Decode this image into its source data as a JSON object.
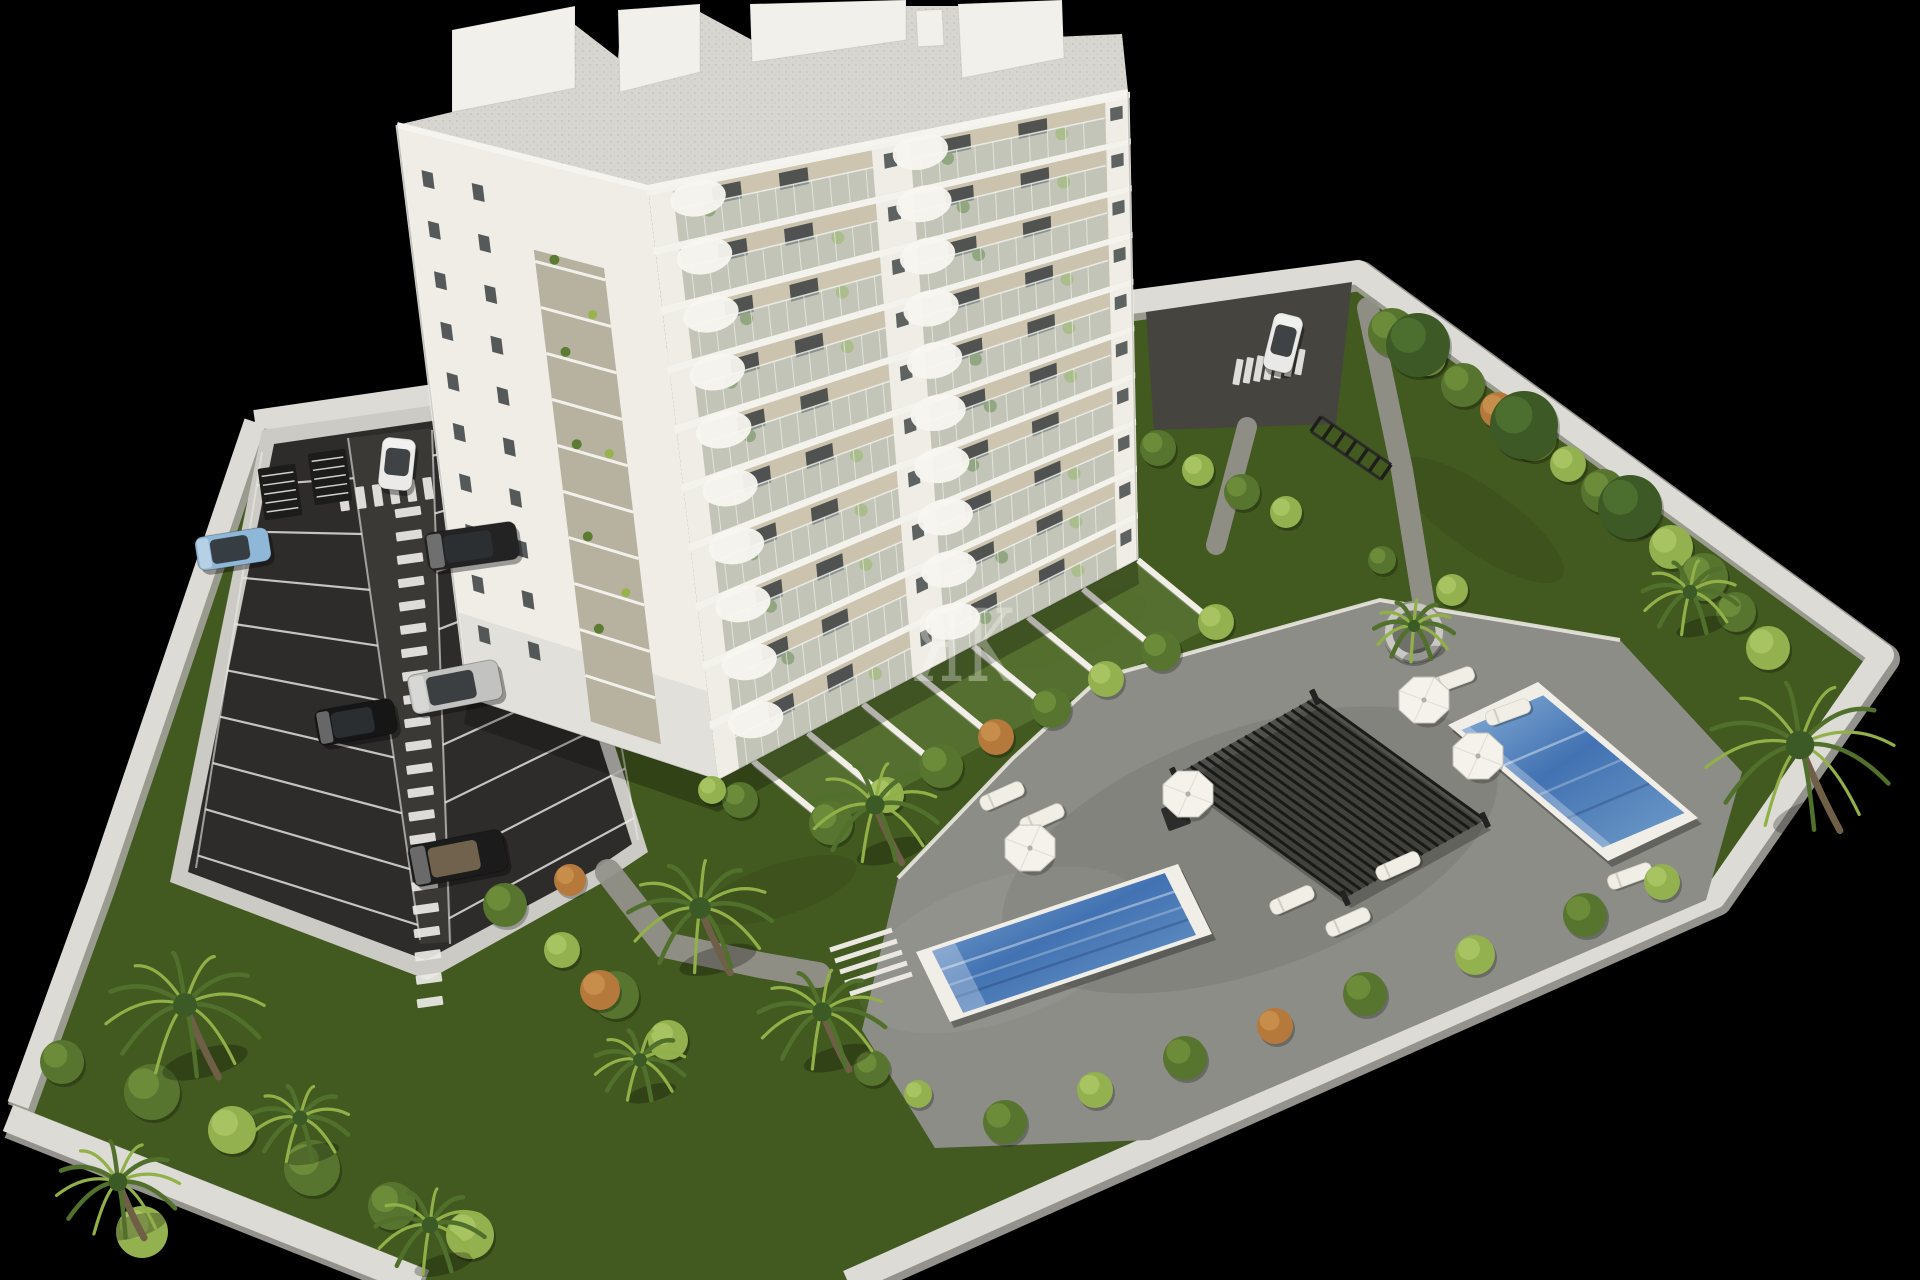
{
  "scene": {
    "description": "Aerial 3D architectural render: white multi-storey apartment building with balconies, landscaped garden, two blue swimming pools, sun deck with pergola and loungers, parking lot with cars, palm trees, white perimeter walls, on a black background",
    "background": "#000000",
    "watermark": {
      "text": "ЯK",
      "color": "#fbfaf6",
      "opacity": 0.33,
      "x": 912,
      "y": 681,
      "font_size": 100
    },
    "palette": {
      "wallLight": "#dcdbd5",
      "wallShade": "#a3a29b",
      "asphalt": "#2e2c2b",
      "asphaltLight": "#403e3c",
      "lineWhite": "#eceae6",
      "grass": "#42591f",
      "grassLight": "#567131",
      "apron": "#cbcac4",
      "deck": "#8d8d87",
      "pathGray": "#92918b",
      "poolBorder": "#f0eee7",
      "waterDeep": "#4272b2",
      "waterLight": "#86aed6",
      "buildingWhite": "#efede6",
      "facadeBeige": "#cdc5b0",
      "windowDark": "#3a3e3f",
      "plantGreen": "#5d7c33",
      "plantLight": "#97b34b",
      "palmDark": "#50702c",
      "palmLight": "#92b048",
      "roofSpeckle": "#d8d6d0"
    },
    "site": {
      "ground": [
        [
          255,
          422
        ],
        [
          1358,
          272
        ],
        [
          1882,
          655
        ],
        [
          1714,
          897
        ],
        [
          848,
          1282
        ],
        [
          408,
          1282
        ],
        [
          8,
          1118
        ],
        [
          98,
          885
        ]
      ],
      "walls": [
        {
          "pts": [
            [
              255,
              422
            ],
            [
              600,
              372
            ],
            [
              1358,
              272
            ],
            [
              1882,
              655
            ],
            [
              1714,
              897
            ],
            [
              848,
              1282
            ]
          ],
          "w": 24
        },
        {
          "pts": [
            [
              255,
              422
            ],
            [
              98,
              885
            ],
            [
              18,
              1105
            ]
          ],
          "w": 22
        },
        {
          "pts": [
            [
              8,
              1118
            ],
            [
              420,
              1282
            ]
          ],
          "w": 28
        }
      ]
    },
    "parking": {
      "apron": [
        [
          262,
          430
        ],
        [
          505,
          395
        ],
        [
          648,
          852
        ],
        [
          600,
          884
        ],
        [
          428,
          980
        ],
        [
          170,
          882
        ]
      ],
      "asphalt": [
        [
          274,
          444
        ],
        [
          494,
          412
        ],
        [
          632,
          844
        ],
        [
          594,
          870
        ],
        [
          426,
          960
        ],
        [
          188,
          872
        ]
      ],
      "lane": [
        [
          348,
          438
        ],
        [
          432,
          428
        ],
        [
          452,
          942
        ],
        [
          420,
          944
        ]
      ],
      "stall_fans": [
        {
          "a0": [
            262,
            452
          ],
          "a1": [
            196,
            868
          ],
          "b0": [
            348,
            438
          ],
          "b1": [
            420,
            940
          ],
          "n": 9,
          "t0": 0.08,
          "t1": 0.97
        },
        {
          "a0": [
            432,
            430
          ],
          "a1": [
            450,
            944
          ],
          "b0": [
            560,
            400
          ],
          "b1": [
            638,
            840
          ],
          "n": 9,
          "t0": 0.05,
          "t1": 0.95
        }
      ],
      "zebras": [
        {
          "from": [
            344,
            500
          ],
          "to": [
            546,
            472
          ],
          "count": 13,
          "bw": 9,
          "bl": 22,
          "rot": -8
        },
        {
          "from": [
            408,
            512
          ],
          "to": [
            430,
            1002
          ],
          "count": 22,
          "bw": 26,
          "bl": 9,
          "rot": -8
        }
      ],
      "bike_racks": [
        {
          "x": 280,
          "y": 492,
          "rot": -8
        },
        {
          "x": 330,
          "y": 477,
          "rot": -8
        }
      ]
    },
    "driveway": {
      "quad": [
        [
          1146,
          312
        ],
        [
          1352,
          282
        ],
        [
          1336,
          424
        ],
        [
          1154,
          430
        ]
      ],
      "zebra": {
        "from": [
          1238,
          372
        ],
        "to": [
          1300,
          362
        ],
        "count": 7,
        "bw": 7,
        "bl": 26,
        "rot": 10
      }
    },
    "paths": [
      {
        "pts": [
          [
            1368,
            308
          ],
          [
            1402,
            470
          ],
          [
            1426,
            618
          ],
          [
            1490,
            660
          ]
        ],
        "w": 22
      },
      {
        "pts": [
          [
            1247,
            427
          ],
          [
            1216,
            545
          ]
        ],
        "w": 20
      },
      {
        "pts": [
          [
            608,
            872
          ],
          [
            665,
            945
          ],
          [
            760,
            965
          ],
          [
            818,
            975
          ]
        ],
        "w": 26
      }
    ],
    "terraces": {
      "bases": [
        [
          753,
          761
        ],
        [
          808,
          733
        ],
        [
          863,
          704
        ],
        [
          918,
          675
        ],
        [
          973,
          646
        ],
        [
          1028,
          617
        ],
        [
          1083,
          589
        ],
        [
          1138,
          560
        ]
      ],
      "vec": [
        78,
        64
      ],
      "wall_w": 6
    },
    "deck": {
      "outline": [
        [
          1013,
          758
        ],
        [
          1100,
          678
        ],
        [
          1380,
          600
        ],
        [
          1620,
          640
        ],
        [
          1742,
          772
        ],
        [
          1706,
          900
        ],
        [
          1150,
          1140
        ],
        [
          935,
          1148
        ],
        [
          862,
          1030
        ],
        [
          898,
          878
        ]
      ],
      "curb": [
        [
          898,
          878
        ],
        [
          1013,
          758
        ],
        [
          1100,
          678
        ],
        [
          1380,
          600
        ],
        [
          1620,
          640
        ]
      ],
      "steps": {
        "x": 830,
        "y": 950,
        "n": 5
      },
      "firepit": {
        "x": 1176,
        "y": 816,
        "s": 24,
        "rot": -20
      }
    },
    "pools": [
      {
        "outer": [
          [
            916,
            952
          ],
          [
            1178,
            864
          ],
          [
            1212,
            934
          ],
          [
            950,
            1022
          ]
        ],
        "inset": 10
      },
      {
        "outer": [
          [
            1448,
            725
          ],
          [
            1538,
            682
          ],
          [
            1698,
            818
          ],
          [
            1608,
            861
          ]
        ],
        "inset": 9
      }
    ],
    "pergola": {
      "corners": [
        [
          1175,
          775
        ],
        [
          1315,
          697
        ],
        [
          1485,
          820
        ],
        [
          1345,
          898
        ]
      ],
      "slats": 18
    },
    "furniture": {
      "parasols": [
        [
          1030,
          848
        ],
        [
          1188,
          794
        ],
        [
          1424,
          700
        ],
        [
          1478,
          756
        ]
      ],
      "loungers": [
        [
          1002,
          796,
          -24
        ],
        [
          1042,
          818,
          -24
        ],
        [
          1292,
          900,
          -24
        ],
        [
          1348,
          922,
          -24
        ],
        [
          1398,
          866,
          -24
        ],
        [
          1452,
          680,
          -20
        ],
        [
          1508,
          712,
          -20
        ],
        [
          1630,
          876,
          -20
        ]
      ]
    },
    "planter": {
      "x": 1414,
      "y": 632,
      "r": 30
    },
    "rack_lawn": {
      "a": [
        1316,
        424
      ],
      "b": [
        1386,
        472
      ],
      "rungs": 7
    },
    "building": {
      "lf": {
        "t0": [
          397,
          125
        ],
        "t1": [
          648,
          188
        ],
        "b0": [
          468,
          698
        ],
        "b1": [
          718,
          780
        ],
        "win_u": [
          0.1,
          0.3
        ],
        "rows": 10,
        "strip_u": [
          0.5,
          0.78
        ]
      },
      "ff": {
        "t0": [
          648,
          188
        ],
        "t1": [
          1128,
          92
        ],
        "b0": [
          718,
          780
        ],
        "b1": [
          1137,
          560
        ],
        "floors": 10,
        "piers": [
          [
            0,
            0.05
          ],
          [
            0.465,
            0.545
          ],
          [
            0.952,
            1.0
          ]
        ],
        "awning_u": [
          0.1,
          0.565
        ]
      },
      "roof": [
        [
          397,
          125
        ],
        [
          648,
          188
        ],
        [
          1128,
          92
        ],
        [
          1122,
          34
        ],
        [
          986,
          40
        ],
        [
          962,
          6
        ],
        [
          756,
          6
        ],
        [
          752,
          40
        ],
        [
          700,
          12
        ],
        [
          622,
          14
        ],
        [
          618,
          58
        ],
        [
          574,
          24
        ],
        [
          456,
          38
        ],
        [
          452,
          112
        ]
      ],
      "parapet": [
        [
          397,
          125
        ],
        [
          648,
          188
        ],
        [
          1128,
          92
        ]
      ],
      "penthouses": [
        [
          [
            452,
            112
          ],
          [
            452,
            30
          ],
          [
            575,
            6
          ],
          [
            575,
            88
          ]
        ],
        [
          [
            620,
            92
          ],
          [
            618,
            10
          ],
          [
            700,
            4
          ],
          [
            700,
            72
          ]
        ],
        [
          [
            752,
            62
          ],
          [
            750,
            4
          ],
          [
            906,
            0
          ],
          [
            906,
            40
          ]
        ],
        [
          [
            962,
            78
          ],
          [
            958,
            4
          ],
          [
            1062,
            0
          ],
          [
            1064,
            58
          ]
        ]
      ],
      "chimney": {
        "x": 930,
        "y": 28,
        "w": 26,
        "h": 36
      },
      "shadow": [
        [
          468,
          698
        ],
        [
          718,
          780
        ],
        [
          1137,
          560
        ],
        [
          1139,
          584
        ],
        [
          718,
          812
        ],
        [
          464,
          724
        ]
      ]
    },
    "vehicles": [
      {
        "type": "sedan",
        "x": 397,
        "y": 464,
        "w": 34,
        "h": 52,
        "rot": 6,
        "color": "#eceae8"
      },
      {
        "type": "sedan",
        "x": 233,
        "y": 549,
        "w": 74,
        "h": 34,
        "rot": -9,
        "color": "#8fb7d8"
      },
      {
        "type": "suv",
        "x": 472,
        "y": 546,
        "w": 92,
        "h": 38,
        "rot": -8,
        "color": "#232323"
      },
      {
        "type": "sedan",
        "x": 455,
        "y": 687,
        "w": 92,
        "h": 40,
        "rot": -11,
        "color": "#c2c2c0"
      },
      {
        "type": "sedan",
        "x": 356,
        "y": 722,
        "w": 80,
        "h": 36,
        "rot": -10,
        "color": "#161616"
      },
      {
        "type": "convertible",
        "x": 458,
        "y": 858,
        "w": 96,
        "h": 42,
        "rot": -11,
        "color": "#1b1b1b"
      },
      {
        "type": "sedan",
        "x": 1283,
        "y": 343,
        "w": 30,
        "h": 58,
        "rot": 14,
        "color": "#e9e9e7"
      }
    ],
    "flora": {
      "bush_colors": [
        "#57752f",
        "#93b14f",
        "#b5793c",
        "#3d5a26"
      ],
      "bush_hl": [
        "#6f8f3c",
        "#aac564",
        "#c98f4d",
        "#4e7030"
      ],
      "palms": [
        [
          185,
          1005,
          80
        ],
        [
          118,
          1182,
          62
        ],
        [
          300,
          1118,
          50
        ],
        [
          430,
          1225,
          55
        ],
        [
          700,
          908,
          72
        ],
        [
          822,
          1012,
          64
        ],
        [
          875,
          805,
          64
        ],
        [
          640,
          1060,
          46
        ],
        [
          1800,
          745,
          95
        ],
        [
          1690,
          592,
          48
        ],
        [
          1414,
          626,
          40
        ]
      ],
      "bushes": [
        [
          831,
          823,
          22,
          0
        ],
        [
          886,
          795,
          18,
          1
        ],
        [
          941,
          766,
          22,
          0
        ],
        [
          996,
          737,
          18,
          2
        ],
        [
          1051,
          708,
          20,
          0
        ],
        [
          1106,
          679,
          18,
          1
        ],
        [
          1161,
          651,
          20,
          0
        ],
        [
          1216,
          622,
          18,
          1
        ],
        [
          740,
          800,
          18,
          0
        ],
        [
          712,
          790,
          14,
          1
        ],
        [
          1392,
          332,
          24,
          0
        ],
        [
          1428,
          358,
          18,
          1
        ],
        [
          1463,
          385,
          22,
          0
        ],
        [
          1498,
          410,
          18,
          2
        ],
        [
          1533,
          437,
          24,
          0
        ],
        [
          1568,
          464,
          18,
          1
        ],
        [
          1603,
          491,
          22,
          0
        ],
        [
          1638,
          518,
          18,
          0
        ],
        [
          1671,
          547,
          22,
          1
        ],
        [
          1704,
          577,
          24,
          0
        ],
        [
          1736,
          612,
          20,
          0
        ],
        [
          1768,
          648,
          22,
          1
        ],
        [
          1418,
          345,
          32,
          3
        ],
        [
          1524,
          425,
          34,
          3
        ],
        [
          1630,
          507,
          32,
          3
        ],
        [
          1005,
          1122,
          22,
          0
        ],
        [
          1095,
          1090,
          18,
          1
        ],
        [
          1185,
          1058,
          22,
          0
        ],
        [
          1275,
          1026,
          18,
          2
        ],
        [
          1365,
          994,
          22,
          0
        ],
        [
          1475,
          955,
          20,
          1
        ],
        [
          1585,
          915,
          22,
          0
        ],
        [
          1662,
          882,
          18,
          1
        ],
        [
          152,
          1092,
          28,
          0
        ],
        [
          232,
          1130,
          24,
          1
        ],
        [
          312,
          1168,
          28,
          0
        ],
        [
          392,
          1206,
          24,
          0
        ],
        [
          142,
          1232,
          26,
          1
        ],
        [
          62,
          1062,
          22,
          0
        ],
        [
          470,
          1235,
          24,
          1
        ],
        [
          505,
          905,
          22,
          0
        ],
        [
          562,
          950,
          18,
          1
        ],
        [
          615,
          995,
          24,
          0
        ],
        [
          668,
          1040,
          20,
          1
        ],
        [
          570,
          880,
          16,
          2
        ],
        [
          600,
          990,
          20,
          2
        ],
        [
          1158,
          448,
          18,
          0
        ],
        [
          1198,
          470,
          16,
          1
        ],
        [
          1242,
          492,
          18,
          0
        ],
        [
          1286,
          512,
          16,
          1
        ],
        [
          872,
          1068,
          18,
          0
        ],
        [
          918,
          1094,
          14,
          1
        ],
        [
          1452,
          590,
          16,
          1
        ],
        [
          1382,
          560,
          14,
          0
        ]
      ],
      "grass_patches": [
        [
          1240,
          700,
          120,
          38,
          -18
        ],
        [
          1060,
          630,
          90,
          30,
          -18
        ],
        [
          1480,
          520,
          100,
          32,
          35
        ],
        [
          780,
          890,
          80,
          26,
          -18
        ],
        [
          1600,
          768,
          90,
          28,
          35
        ],
        [
          500,
          760,
          70,
          24,
          -15
        ]
      ]
    }
  }
}
